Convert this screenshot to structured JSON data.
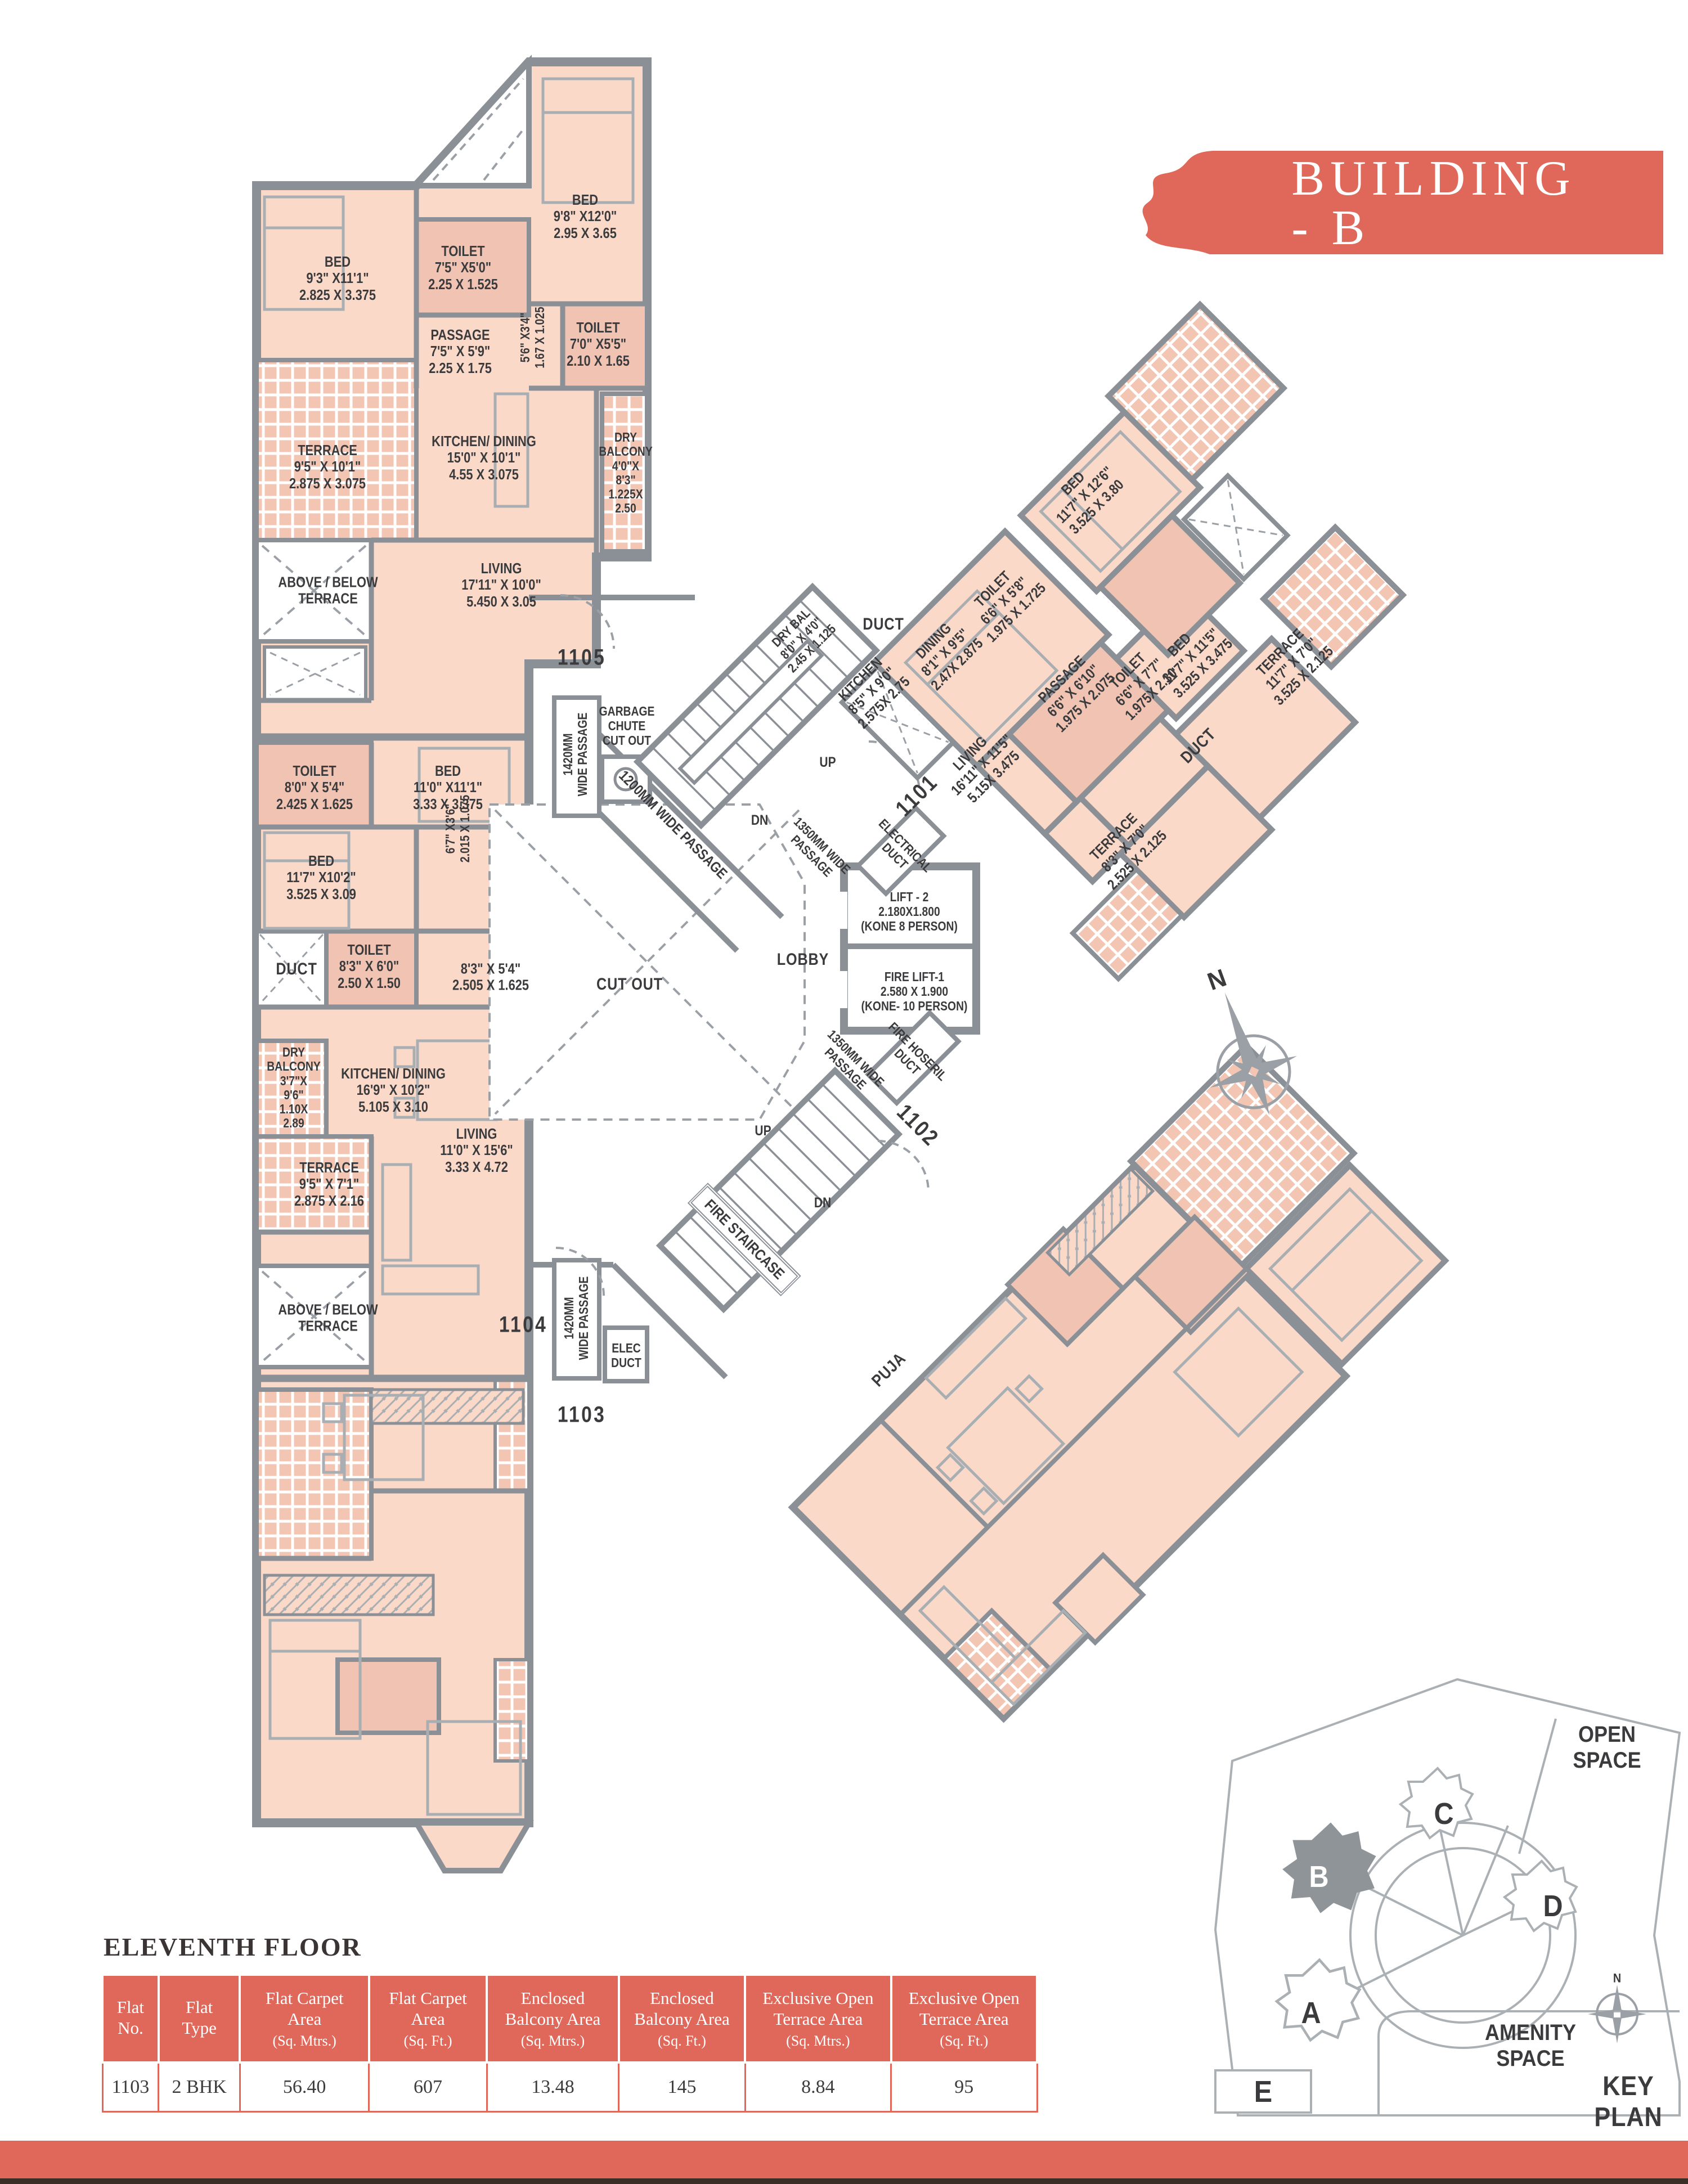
{
  "banner": {
    "title": "BUILDING - B"
  },
  "floor_title": "ELEVENTH FLOOR",
  "table": {
    "headers": [
      [
        "Flat\nNo.",
        ""
      ],
      [
        "Flat\nType",
        ""
      ],
      [
        "Flat Carpet\nArea",
        "(Sq. Mtrs.)"
      ],
      [
        "Flat Carpet\nArea",
        "(Sq. Ft.)"
      ],
      [
        "Enclosed\nBalcony Area",
        "(Sq. Mtrs.)"
      ],
      [
        "Enclosed\nBalcony Area",
        "(Sq. Ft.)"
      ],
      [
        "Exclusive Open\nTerrace Area",
        "(Sq. Mtrs.)"
      ],
      [
        "Exclusive Open\nTerrace Area",
        "(Sq. Ft.)"
      ]
    ],
    "row": [
      "1103",
      "2 BHK",
      "56.40",
      "607",
      "13.48",
      "145",
      "8.84",
      "95"
    ]
  },
  "key_plan": {
    "open_space": "OPEN\nSPACE",
    "amenity_space": "AMENITY SPACE",
    "title": "KEY PLAN",
    "north": "N",
    "buildings": {
      "a": "A",
      "b": "B",
      "c": "C",
      "d": "D",
      "e": "E"
    }
  },
  "compass": {
    "north": "N"
  },
  "plan_labels": [
    {
      "name": "bed-1105-a",
      "lines": [
        "BED",
        "9'3\" X11'1\"",
        "2.825 X 3.375"
      ]
    },
    {
      "name": "toilet-1105-a",
      "lines": [
        "TOILET",
        "7'5\" X5'0\"",
        "2.25 X 1.525"
      ]
    },
    {
      "name": "bed-1105-b",
      "lines": [
        "BED",
        "9'8\" X12'0\"",
        "2.95 X 3.65"
      ]
    },
    {
      "name": "passage-1105",
      "lines": [
        "PASSAGE",
        "7'5\" X 5'9\"",
        "2.25 X 1.75"
      ]
    },
    {
      "name": "passage-5-6",
      "lines": [
        "5'6\" X3'4\"",
        "1.67 X 1.025"
      ]
    },
    {
      "name": "toilet-1105-b",
      "lines": [
        "TOILET",
        "7'0\" X5'5\"",
        "2.10 X 1.65"
      ]
    },
    {
      "name": "terrace-1105",
      "lines": [
        "TERRACE",
        "9'5\" X 10'1\"",
        "2.875 X 3.075"
      ]
    },
    {
      "name": "kitchen-dining-1105",
      "lines": [
        "KITCHEN/ DINING",
        "15'0\" X 10'1\"",
        "4.55 X 3.075"
      ]
    },
    {
      "name": "dry-balcony-1105",
      "lines": [
        "DRY",
        "BALCONY",
        "4'0\"X",
        "8'3\"",
        "1.225X",
        "2.50"
      ]
    },
    {
      "name": "living-1105",
      "lines": [
        "LIVING",
        "17'11\" X 10'0\"",
        "5.450 X 3.05"
      ]
    },
    {
      "name": "above-below-terrace-1",
      "lines": [
        "ABOVE / BELOW",
        "TERRACE"
      ]
    },
    {
      "name": "flat-number-1105",
      "lines": [
        "1105"
      ]
    },
    {
      "name": "garbage-chute",
      "lines": [
        "GARBAGE",
        "CHUTE",
        "CUT OUT"
      ]
    },
    {
      "name": "passage-1420-a",
      "lines": [
        "1420MM",
        "WIDE PASSAGE"
      ]
    },
    {
      "name": "toilet-1104-a",
      "lines": [
        "TOILET",
        "8'0\" X 5'4\"",
        "2.425 X 1.625"
      ]
    },
    {
      "name": "bed-1104-a",
      "lines": [
        "BED",
        "11'0\" X11'1\"",
        "3.33 X 3.375"
      ]
    },
    {
      "name": "bed-1104-b",
      "lines": [
        "BED",
        "11'7\" X10'2\"",
        "3.525 X 3.09"
      ]
    },
    {
      "name": "passage-6-7",
      "lines": [
        "6'7\" X3'6\"",
        "2.015 X 1.075"
      ]
    },
    {
      "name": "duct-1104",
      "lines": [
        "DUCT"
      ]
    },
    {
      "name": "toilet-1104-b",
      "lines": [
        "TOILET",
        "8'3\" X 6'0\"",
        "2.50 X 1.50"
      ]
    },
    {
      "name": "passage-8-3",
      "lines": [
        "8'3\" X 5'4\"",
        "2.505 X 1.625"
      ]
    },
    {
      "name": "dry-balcony-1104",
      "lines": [
        "DRY",
        "BALCONY",
        "3'7\"X",
        "9'6\"",
        "1.10X",
        "2.89"
      ]
    },
    {
      "name": "kitchen-dining-1104",
      "lines": [
        "KITCHEN/ DINING",
        "16'9\" X 10'2\"",
        "5.105 X 3.10"
      ]
    },
    {
      "name": "terrace-1104",
      "lines": [
        "TERRACE",
        "9'5\" X 7'1\"",
        "2.875 X 2.16"
      ]
    },
    {
      "name": "living-1104",
      "lines": [
        "LIVING",
        "11'0\" X 15'6\"",
        "3.33 X 4.72"
      ]
    },
    {
      "name": "above-below-terrace-2",
      "lines": [
        "ABOVE / BELOW",
        "TERRACE"
      ]
    },
    {
      "name": "flat-number-1104",
      "lines": [
        "1104"
      ]
    },
    {
      "name": "passage-1420-b",
      "lines": [
        "1420MM",
        "WIDE PASSAGE"
      ]
    },
    {
      "name": "elec-duct",
      "lines": [
        "ELEC",
        "DUCT"
      ]
    },
    {
      "name": "flat-number-1103",
      "lines": [
        "1103"
      ]
    },
    {
      "name": "stair-up-1",
      "lines": [
        "UP"
      ]
    },
    {
      "name": "stair-dn-1",
      "lines": [
        "DN"
      ]
    },
    {
      "name": "passage-1200",
      "lines": [
        "1200MM WIDE PASSAGE"
      ]
    },
    {
      "name": "cut-out",
      "lines": [
        "CUT OUT"
      ]
    },
    {
      "name": "lobby",
      "lines": [
        "LOBBY"
      ]
    },
    {
      "name": "lift-2",
      "lines": [
        "LIFT - 2",
        "2.180X1.800",
        "(KONE 8 PERSON)"
      ]
    },
    {
      "name": "fire-lift-1",
      "lines": [
        "FIRE LIFT-1",
        "2.580 X 1.900",
        "(KONE- 10 PERSON)"
      ]
    },
    {
      "name": "passage-1350-a",
      "lines": [
        "1350MM WIDE",
        "PASSAGE"
      ]
    },
    {
      "name": "electrical-duct",
      "lines": [
        "ELECTRICAL",
        "DUCT"
      ]
    },
    {
      "name": "passage-1350-b",
      "lines": [
        "1350MM WIDE",
        "PASSAGE"
      ]
    },
    {
      "name": "fire-hose-duct",
      "lines": [
        "FIRE HOSERIL",
        "DUCT"
      ]
    },
    {
      "name": "stair-up-2",
      "lines": [
        "UP"
      ]
    },
    {
      "name": "stair-dn-2",
      "lines": [
        "DN"
      ]
    },
    {
      "name": "fire-staircase",
      "lines": [
        "FIRE STAIRCASE"
      ]
    },
    {
      "name": "flat-number-1102",
      "lines": [
        "1102"
      ]
    },
    {
      "name": "puja",
      "lines": [
        "PUJA"
      ]
    },
    {
      "name": "bed-1101-a",
      "lines": [
        "BED",
        "11'7\" X 12'6\"",
        "3.525 X 3.80"
      ]
    },
    {
      "name": "toilet-1101-a",
      "lines": [
        "TOILET",
        "6'6\" X 5'8\"",
        "1.975 X 1.725"
      ]
    },
    {
      "name": "passage-1101",
      "lines": [
        "PASSAGE",
        "6'6\" X 6'10\"",
        "1.975 X 2.075"
      ]
    },
    {
      "name": "bed-1101-b",
      "lines": [
        "BED",
        "11'7\" X 11'5\"",
        "3.525 X 3.475"
      ]
    },
    {
      "name": "dining-1101",
      "lines": [
        "DINING",
        "8'1\" X 9'5\"",
        "2.47X 2.875"
      ]
    },
    {
      "name": "kitchen-1101",
      "lines": [
        "KITCHEN",
        "8'5\" X 9'0\"",
        "2.575X 2.75"
      ]
    },
    {
      "name": "dry-bal-1101",
      "lines": [
        "DRY BAL",
        "8'0\" X 4'0\"",
        "2.45 X 1.125"
      ]
    },
    {
      "name": "living-1101",
      "lines": [
        "LIVING",
        "16'11\" X 11'5\"",
        "5.15X 3.475"
      ]
    },
    {
      "name": "toilet-1101-b",
      "lines": [
        "TOILET",
        "6'6\" X 7'7\"",
        "1.975X 2.30"
      ]
    },
    {
      "name": "terrace-1101-a",
      "lines": [
        "TERRACE",
        "11'7\" X 7'0\"",
        "3.525 X 2.125"
      ]
    },
    {
      "name": "duct-1101",
      "lines": [
        "DUCT"
      ]
    },
    {
      "name": "terrace-1101-b",
      "lines": [
        "TERRACE",
        "8'3\" X 7'0\"",
        "2.525 X 2.125"
      ]
    },
    {
      "name": "duct-1101-h",
      "lines": [
        "DUCT"
      ]
    },
    {
      "name": "flat-number-1101",
      "lines": [
        "1101"
      ]
    }
  ]
}
